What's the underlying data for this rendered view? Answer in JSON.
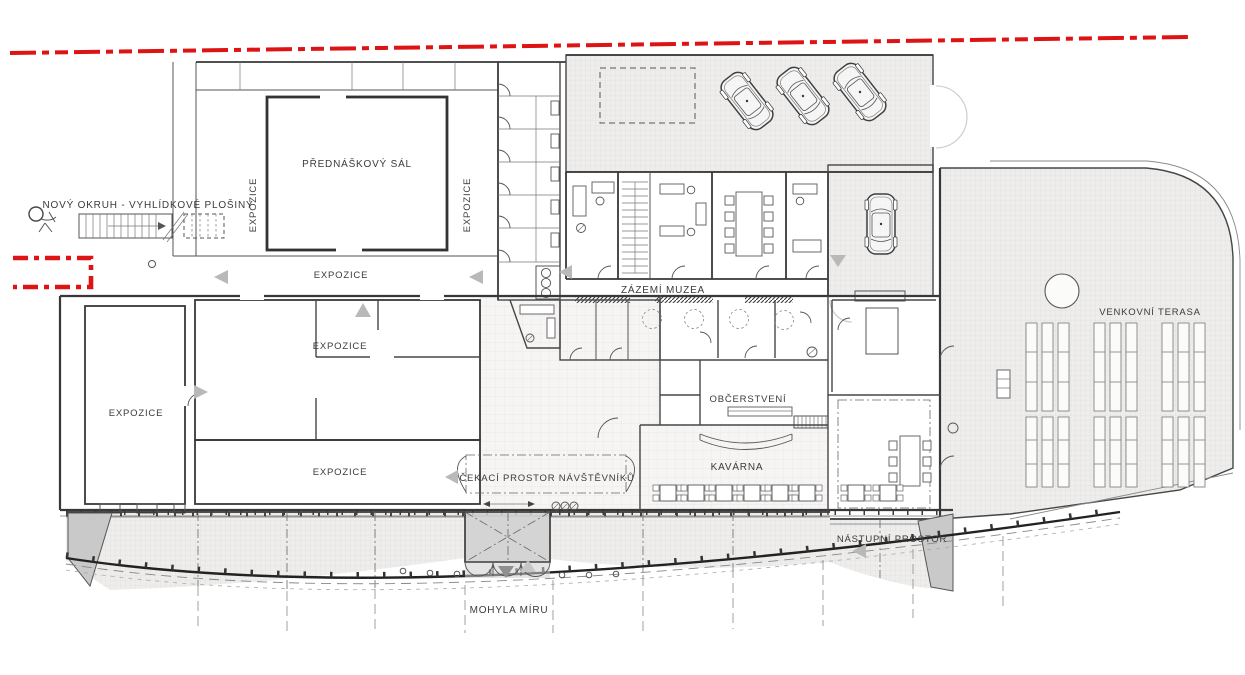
{
  "drawing": {
    "type": "architectural-floor-plan",
    "labels": {
      "novy_okruh": "NOVÝ OKRUH - VYHLÍDKOVÉ PLOŠINY",
      "prednaskovy_sal": "PŘEDNÁŠKOVÝ SÁL",
      "expozice": "EXPOZICE",
      "zazemi_muzea": "ZÁZEMÍ MUZEA",
      "obcerstveni": "OBČERSTVENÍ",
      "kavarna": "KAVÁRNA",
      "cekaci_prostor": "ČEKACÍ PROSTOR NÁVŠTĚVNÍKŮ",
      "venkovni_terasa": "VENKOVNÍ TERASA",
      "nastupni_prostor": "NÁSTUPNÍ PROSTOR",
      "mohyla_miru": "MOHYLA MÍRU"
    },
    "colors": {
      "site_boundary_red": "#dc1414",
      "wall_dark": "#383838",
      "hatch_background": "#eeedec",
      "hatch_line": "#dcdbda",
      "shade_gray": "#c9c9c9",
      "arrow_gray": "#b9b9b9",
      "canvas": "#ffffff"
    }
  }
}
